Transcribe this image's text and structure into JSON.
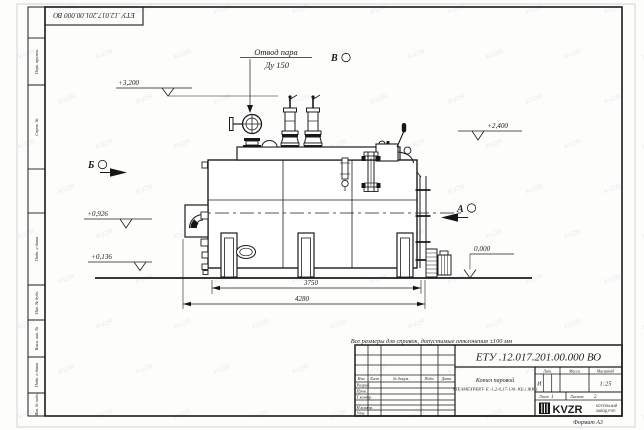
{
  "sheet": {
    "doc_number": "ЕТУ .12.017.201.00.000  ВО",
    "format_label": "Формат А3",
    "note": "Все размеры для справок, допустимые отклонения ±100 мм",
    "watermark": "KVZR"
  },
  "margin_columns": [
    "Перв. примен.",
    "Справ. №",
    "Подп. и дата",
    "Инв. № дубл.",
    "Взам. инв. №",
    "Подп. и дата",
    "Инв. № подл."
  ],
  "title_block": {
    "header_cells": [
      "Изм.",
      "Лист",
      "№ докум.",
      "Подп.",
      "Дата"
    ],
    "rows": [
      "Разраб.",
      "Пров.",
      "Т.контр.",
      "Н.контр.",
      "Утв."
    ],
    "product_name_line1": "Котел паровой",
    "product_name_line2": "STEAMEXPERT- Е -1,2-0,17-130- КБ ( ЖК )",
    "lit_label": "Лит.",
    "lit_value": "И",
    "mass_label": "Масса",
    "scale_label": "Масштаб",
    "scale_value": "1:25",
    "sheet_label": "Лист",
    "sheet_value": "1",
    "sheets_label": "Листов",
    "sheets_value": "2",
    "logo_text": "KVZR",
    "company_line1": "КОТЕЛЬНЫЙ",
    "company_line2": "ЗАВОД РЭП"
  },
  "drawing": {
    "callout_line1": "Отвод пара",
    "callout_line2": "Ду 150",
    "view_labels": [
      "Б",
      "В",
      "А"
    ],
    "elevations": [
      "+3,200",
      "+2,400",
      "+0,926",
      "+0,136",
      "0,000"
    ],
    "dimensions": [
      "3750",
      "4280"
    ]
  }
}
